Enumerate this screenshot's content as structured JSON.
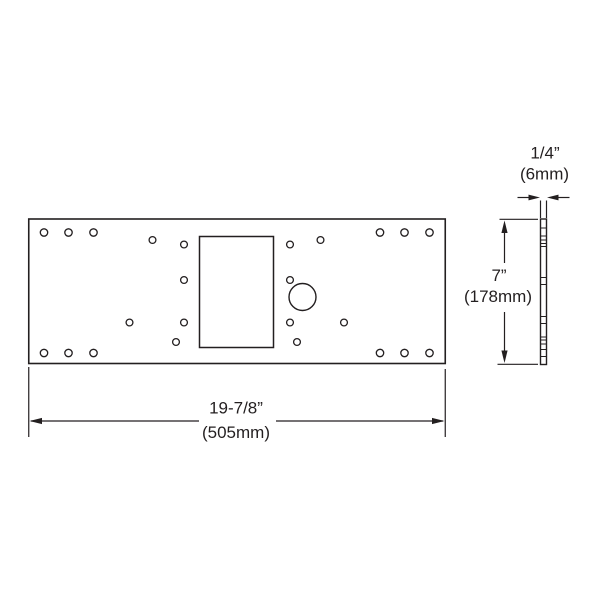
{
  "figure": {
    "type": "technical-dimension-drawing",
    "subject": "rectangular mounting plate with hole pattern, front and side views",
    "background_color": "#ffffff",
    "line_color": "#231f20",
    "front_view": {
      "width": {
        "imperial": "19-7/8”",
        "metric": "(505mm)"
      }
    },
    "side_view": {
      "thickness": {
        "imperial": "1/4”",
        "metric": "(6mm)"
      },
      "height": {
        "imperial": "7”",
        "metric": "(178mm)"
      }
    }
  }
}
